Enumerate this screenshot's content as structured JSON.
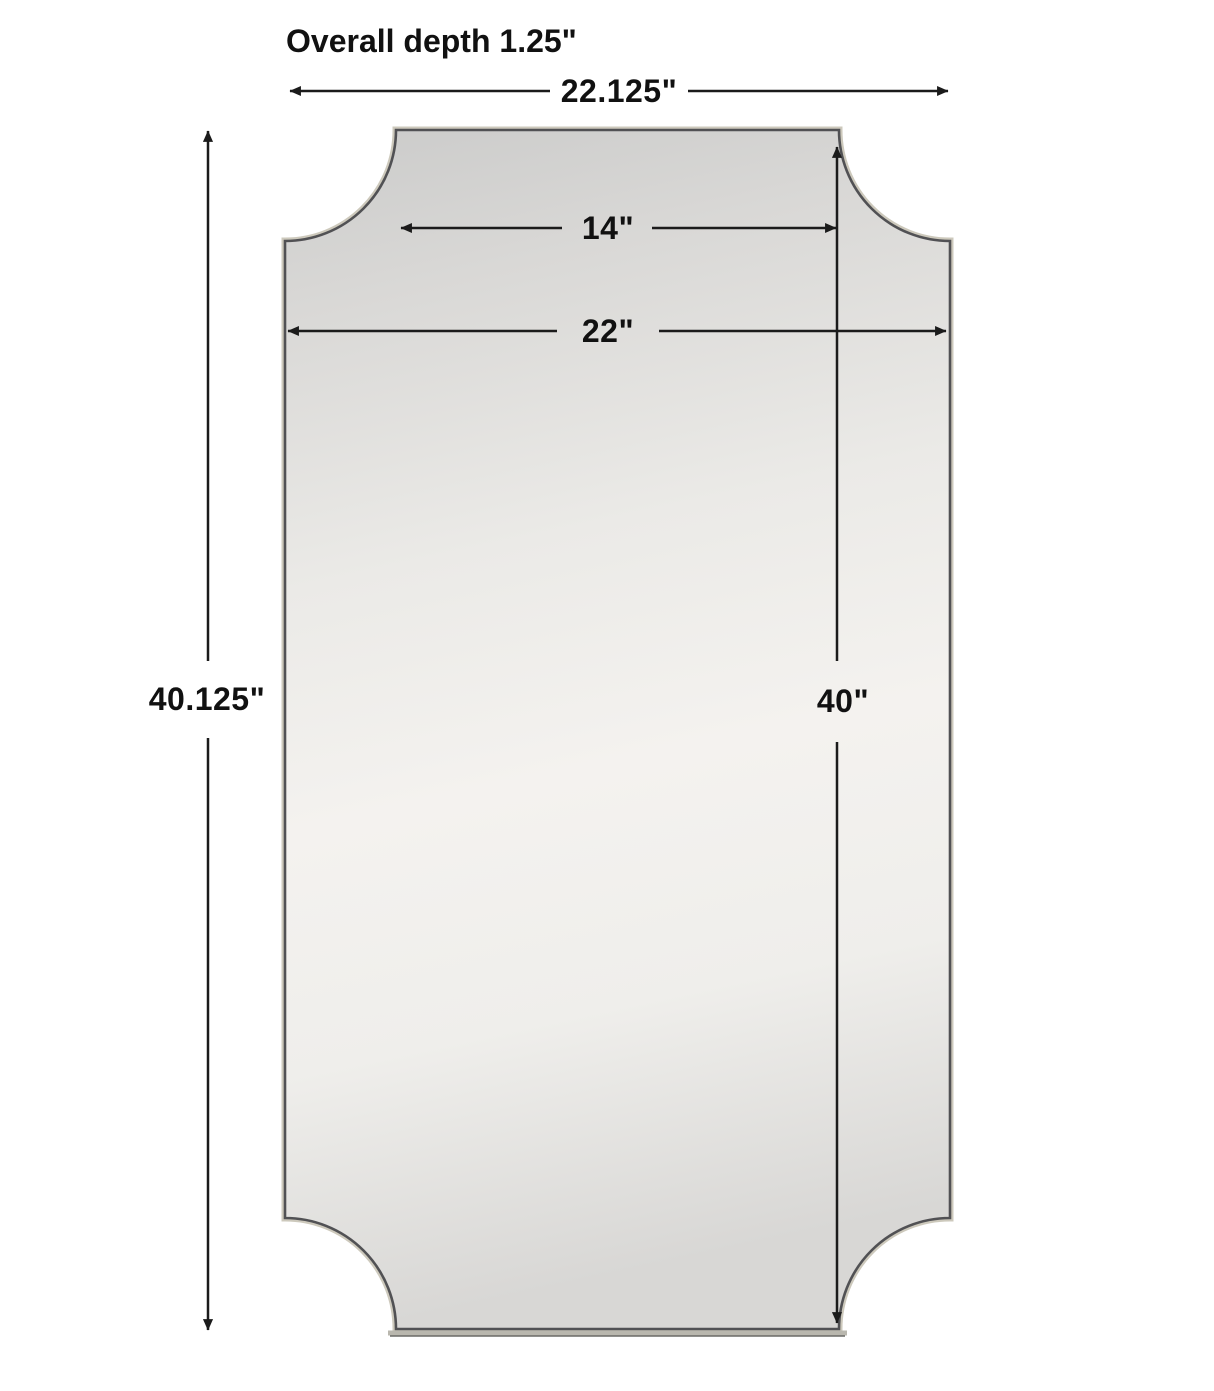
{
  "annotations": {
    "depth_note": "Overall depth 1.25\"",
    "dimensions": [
      {
        "id": "overall-width",
        "label": "22.125\""
      },
      {
        "id": "top-edge-width",
        "label": "14\""
      },
      {
        "id": "body-width",
        "label": "22\""
      },
      {
        "id": "overall-height",
        "label": "40.125\""
      },
      {
        "id": "body-height",
        "label": "40\""
      }
    ]
  },
  "colors": {
    "background": "#ffffff",
    "dimension_line": "#1b1b1b",
    "label_text": "#111111",
    "frame_stroke": "#515154",
    "frame_halo": "#cdc9bc",
    "mirror_light": "#f4f2ef",
    "mirror_dark": "#cbcbca"
  }
}
